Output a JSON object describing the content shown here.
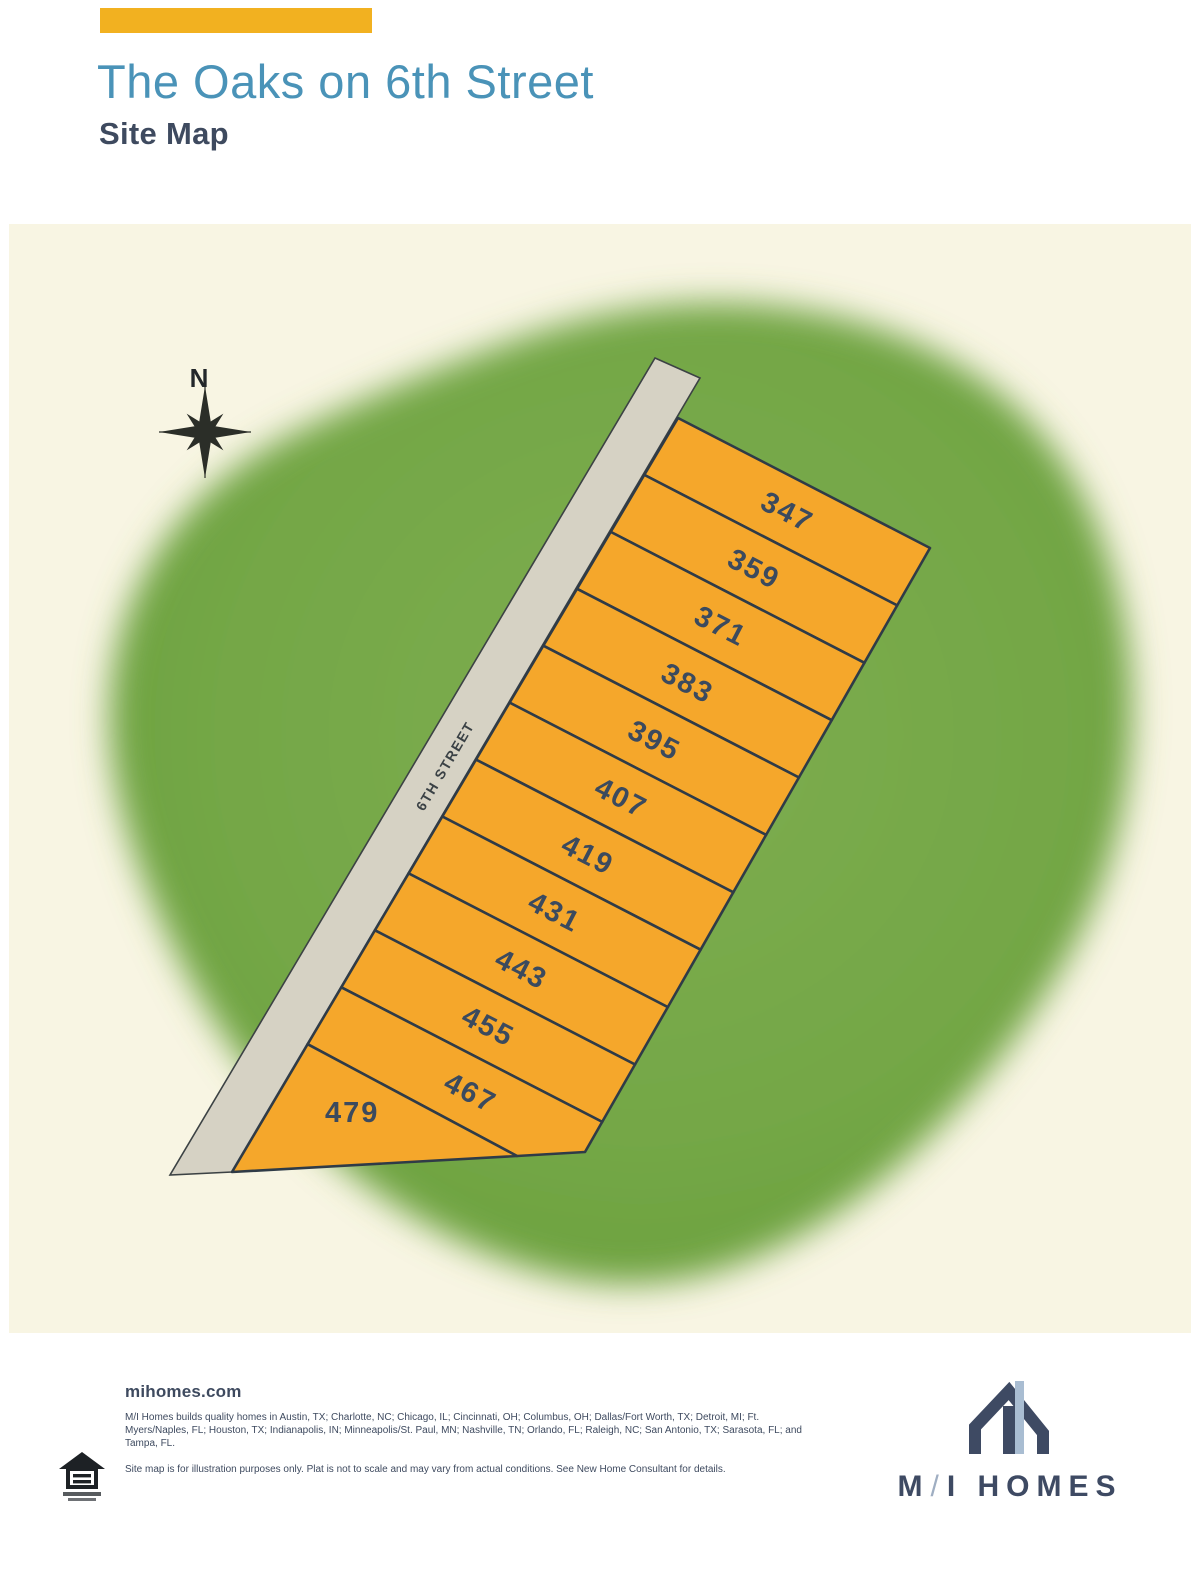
{
  "header": {
    "title": "The Oaks on 6th Street",
    "subtitle": "Site Map"
  },
  "map": {
    "compass_label": "N",
    "street_label": "6TH STREET",
    "lots": [
      "347",
      "359",
      "371",
      "383",
      "395",
      "407",
      "419",
      "431",
      "443",
      "455",
      "467",
      "479"
    ],
    "colors": {
      "panel_bg": "#F8F5E3",
      "greenspace": "#74A746",
      "greenspace_light": "#7EAD51",
      "greenspace_dark": "#699F3C",
      "road_fill": "#D6D2C4",
      "road_edge": "#3C4244",
      "lot_fill": "#F5A72B",
      "lot_border": "#2F3B47",
      "lot_text": "#3B4A5E",
      "street_text": "#3A4145",
      "compass": "#2B2E28"
    }
  },
  "footer": {
    "website": "mihomes.com",
    "markets": "M/I Homes builds quality homes in Austin, TX; Charlotte, NC; Chicago, IL; Cincinnati, OH; Columbus, OH; Dallas/Fort Worth, TX; Detroit, MI; Ft. Myers/Naples, FL; Houston, TX; Indianapolis, IN; Minneapolis/St. Paul, MN; Nashville, TN; Orlando, FL; Raleigh, NC; San Antonio, TX; Sarasota, FL; and Tampa, FL.",
    "disclaimer": "Site map is for illustration purposes only. Plat is not to scale and may vary from actual conditions. See New Home Consultant for details.",
    "logo": {
      "part1": "M",
      "slash": "/",
      "part2": "I HOMES"
    }
  },
  "accent_color": "#F2B120",
  "title_color": "#4A93B8",
  "subtitle_color": "#3E4A5F"
}
